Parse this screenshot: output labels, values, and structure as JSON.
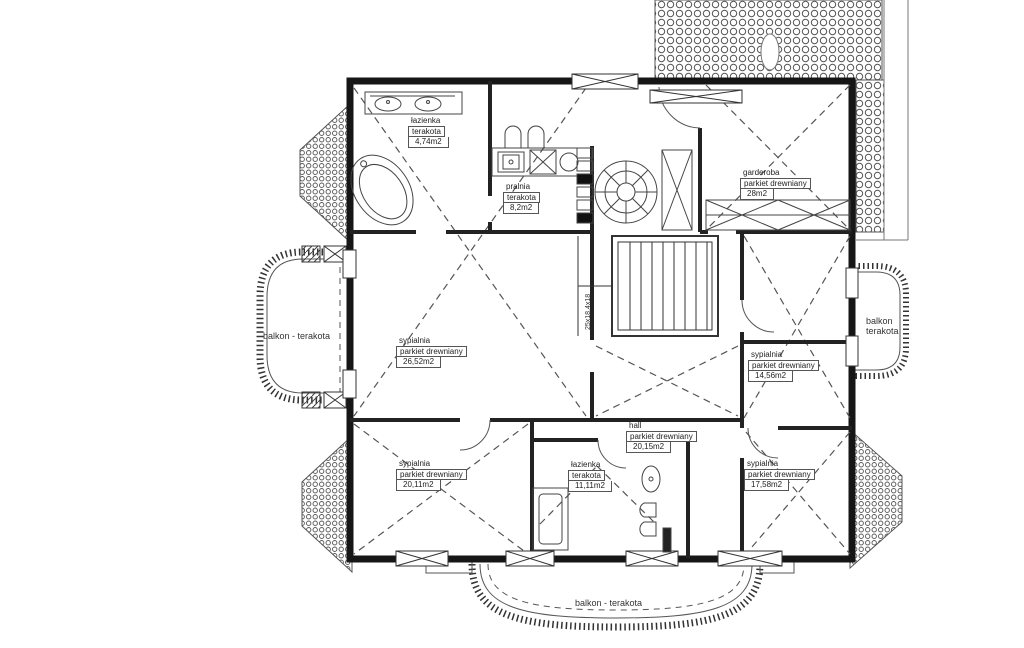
{
  "drawing": {
    "type": "floor-plan",
    "colors": {
      "background": "#ffffff",
      "wall": "#161616",
      "line_medium": "#333333",
      "line_thin": "#555555"
    }
  },
  "rooms": [
    {
      "id": "lazienka-top",
      "name": "łazienka",
      "floor": "terakota",
      "area": "4,74m2"
    },
    {
      "id": "pralnia",
      "name": "pralnia",
      "floor": "terakota",
      "area": "8,2m2"
    },
    {
      "id": "garderoba",
      "name": "garderoba",
      "floor": "parkiet drewniany",
      "area": "28m2"
    },
    {
      "id": "sypialnia-left",
      "name": "sypialnia",
      "floor": "parkiet drewniany",
      "area": "26,52m2"
    },
    {
      "id": "sypialnia-right",
      "name": "sypialnia",
      "floor": "parkiet drewniany",
      "area": "14,56m2"
    },
    {
      "id": "sypialnia-bottom-left",
      "name": "sypialnia",
      "floor": "parkiet drewniany",
      "area": "20,11m2"
    },
    {
      "id": "lazienka-bottom",
      "name": "łazienka",
      "floor": "terakota",
      "area": "11,11m2"
    },
    {
      "id": "hall",
      "name": "hall",
      "floor": "parkiet drewniany",
      "area": "20,15m2"
    },
    {
      "id": "sypialnia-bottom-right",
      "name": "sypialnia",
      "floor": "parkiet drewniany",
      "area": "17,58m2"
    }
  ],
  "balconies": {
    "left": "balkon - terakota",
    "right_line1": "balkon",
    "right_line2": "terakota",
    "bottom": "balkon - terakota"
  },
  "stairs": {
    "dimension": "25x18,4x18"
  }
}
